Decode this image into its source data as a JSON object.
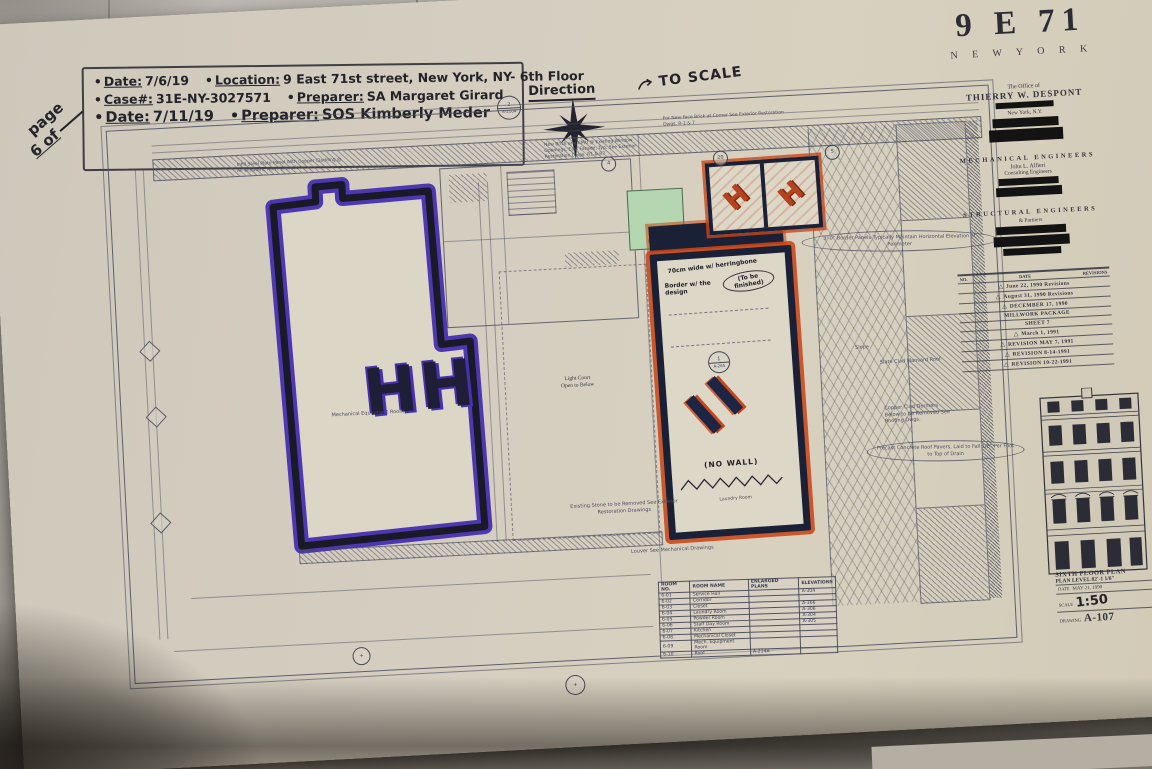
{
  "colors": {
    "purple_marker": "#4730b2",
    "navy_marker": "#1a2136",
    "orange_marker": "#c9461a",
    "green_highlight": "#b4d6b0",
    "paper": "#d5cec0"
  },
  "page_marker": {
    "line1": "page",
    "line2": "6 of"
  },
  "annotations": {
    "bullet": "•",
    "line1": [
      {
        "label": "Date:",
        "value": "7/6/19"
      },
      {
        "label": "Location:",
        "value": "9 East 71st street, New York, NY- 6th Floor"
      }
    ],
    "line2": [
      {
        "label": "Case#:",
        "value": "31E-NY-3027571"
      },
      {
        "label": "Preparer:",
        "value": "SA Margaret Girard"
      }
    ],
    "line3": [
      {
        "label": "Date:",
        "value": "7/11/19"
      },
      {
        "label": "Preparer:",
        "value": "SOS Kimberly Meder"
      }
    ]
  },
  "compass": {
    "label": "Direction",
    "bubble_number": "2",
    "bubble_ref": "A-2104"
  },
  "scale_note": "TO SCALE",
  "plan": {
    "note_topleft": "Infill Steel Plate Panel With Copper Cladding @ All Windows, North Elevation",
    "note_topright": "New Brick and CMU @ Existing Window Openings, East Facade, Typ. See Exterior Restoration Dwgs. R1 & R7",
    "note_corner": "For New Face Brick at Corner See Exterior Restoration Dwgs. R-1 & 7",
    "light_court_1": "Light Court",
    "light_court_2": "Open to Below",
    "elevator": "Elevator",
    "mech_room": "Mechanical Equipment Room",
    "laundry_room": "Laundry Room",
    "no_wall": "(NO WALL)",
    "hw_width": "70cm wide w/ herringbone",
    "hw_border": "Border w/ the design",
    "hw_tobe": "(To be finished)",
    "hh_mark": "HH",
    "ii_mark": "II",
    "h_mark": "H",
    "note_stone": "Existing Stone to be Removed See Exterior Restoration Drawings",
    "note_louver": "Louver See Mechanical Drawings",
    "note_border_panels": "3'-0\" Border Panels Typically Maintain Horizontal Elevation at Perimeter",
    "note_slope": "Slope",
    "note_mansard": "Slate Clad Mansard Roof",
    "note_dormers": "Copper Clad Dormers Below to be Removed See Roofing Dwgs.",
    "note_pavers": "Precast Concrete Roof Pavers, Laid to Fall 1/8\" Per Foot to Top of Drain",
    "court_bubble": {
      "number": "1",
      "ref": "A-265"
    },
    "grid_bubbles": [
      "4",
      "20",
      "5"
    ]
  },
  "schedule": {
    "headers": [
      "ROOM NO.",
      "ROOM NAME",
      "ENLARGED PLANS",
      "ELEVATIONS"
    ],
    "rows": [
      {
        "no": "6-01",
        "name": "Service Hall",
        "enl": "",
        "elev": "A-304"
      },
      {
        "no": "6-02",
        "name": "Corridor",
        "enl": "",
        "elev": ""
      },
      {
        "no": "6-03",
        "name": "Closet",
        "enl": "",
        "elev": "A-366"
      },
      {
        "no": "6-04",
        "name": "Laundry Room",
        "enl": "",
        "elev": "A-306"
      },
      {
        "no": "6-05",
        "name": "Powder Room",
        "enl": "",
        "elev": "A-304"
      },
      {
        "no": "6-06",
        "name": "Staff Day Room",
        "enl": "",
        "elev": "A-305"
      },
      {
        "no": "6-07",
        "name": "Kitchen",
        "enl": "",
        "elev": ""
      },
      {
        "no": "6-08",
        "name": "Mechanical Closet",
        "enl": "",
        "elev": ""
      },
      {
        "no": "6-09",
        "name": "Mech. Equipment Room",
        "enl": "",
        "elev": ""
      },
      {
        "no": "6-10",
        "name": "Roof",
        "enl": "A-214A",
        "elev": ""
      }
    ]
  },
  "titleblock": {
    "project": "9 E 71",
    "city": "N E W   Y O R K",
    "office_line": "The Office of",
    "architect": "THIERRY W. DESPONT",
    "architect_city": "New York, N.Y.",
    "mech_heading": "MECHANICAL ENGINEERS",
    "mech_name": "John L. Alfieri",
    "mech_firm": "Consulting Engineers",
    "struct_heading": "STRUCTURAL ENGINEERS",
    "struct_firm": "& Partners",
    "rev_headers": [
      "NO.",
      "DATE",
      "REVISIONS"
    ],
    "revisions": [
      {
        "glyph": "△",
        "text": "June 22, 1990 Revisions"
      },
      {
        "glyph": "△",
        "text": "August 31, 1990 Revisions"
      },
      {
        "glyph": "△",
        "text": "DECEMBER 17, 1990"
      },
      {
        "glyph": "",
        "text": "MILLWORK PACKAGE"
      },
      {
        "glyph": "",
        "text": "SHEET 7"
      },
      {
        "glyph": "△",
        "text": "March 1, 1991"
      },
      {
        "glyph": "△",
        "text": "REVISION MAY 7, 1991"
      },
      {
        "glyph": "△",
        "text": "REVISION 8-14-1991"
      },
      {
        "glyph": "△",
        "text": "REVISION 10-22-1991"
      }
    ],
    "drawing_title_line1": "SIXTH FLOOR PLAN",
    "drawing_title_line2": "PLAN LEVEL 82'-1 1/8\"",
    "date_label": "DATE",
    "date_value": "MAY 21, 1990",
    "scale_label": "SCALE",
    "scale_value": "1:50",
    "drawing_label": "DRAWING",
    "drawing_number": "A-107"
  }
}
